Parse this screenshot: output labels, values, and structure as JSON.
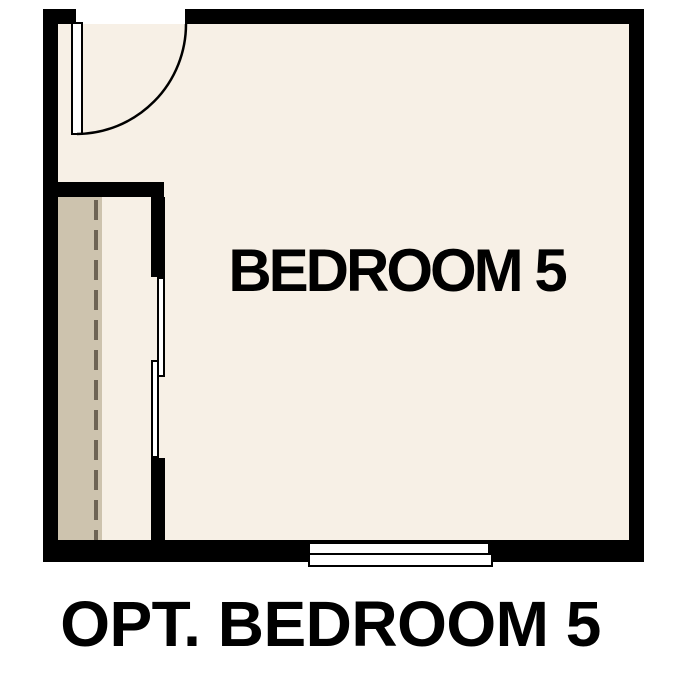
{
  "plan": {
    "room_label": "BEDROOM 5",
    "caption": "OPT. BEDROOM 5",
    "features": [
      "hinged-door-top-left",
      "closet-with-bypass-sliding-doors",
      "closet-rod-dashed-line",
      "window-bottom-wall"
    ]
  },
  "colors": {
    "page": "#ffffff",
    "floor": "#f7f0e6",
    "closet": "#cdc3ae",
    "dash": "#6e6455",
    "wall": "#000000"
  }
}
